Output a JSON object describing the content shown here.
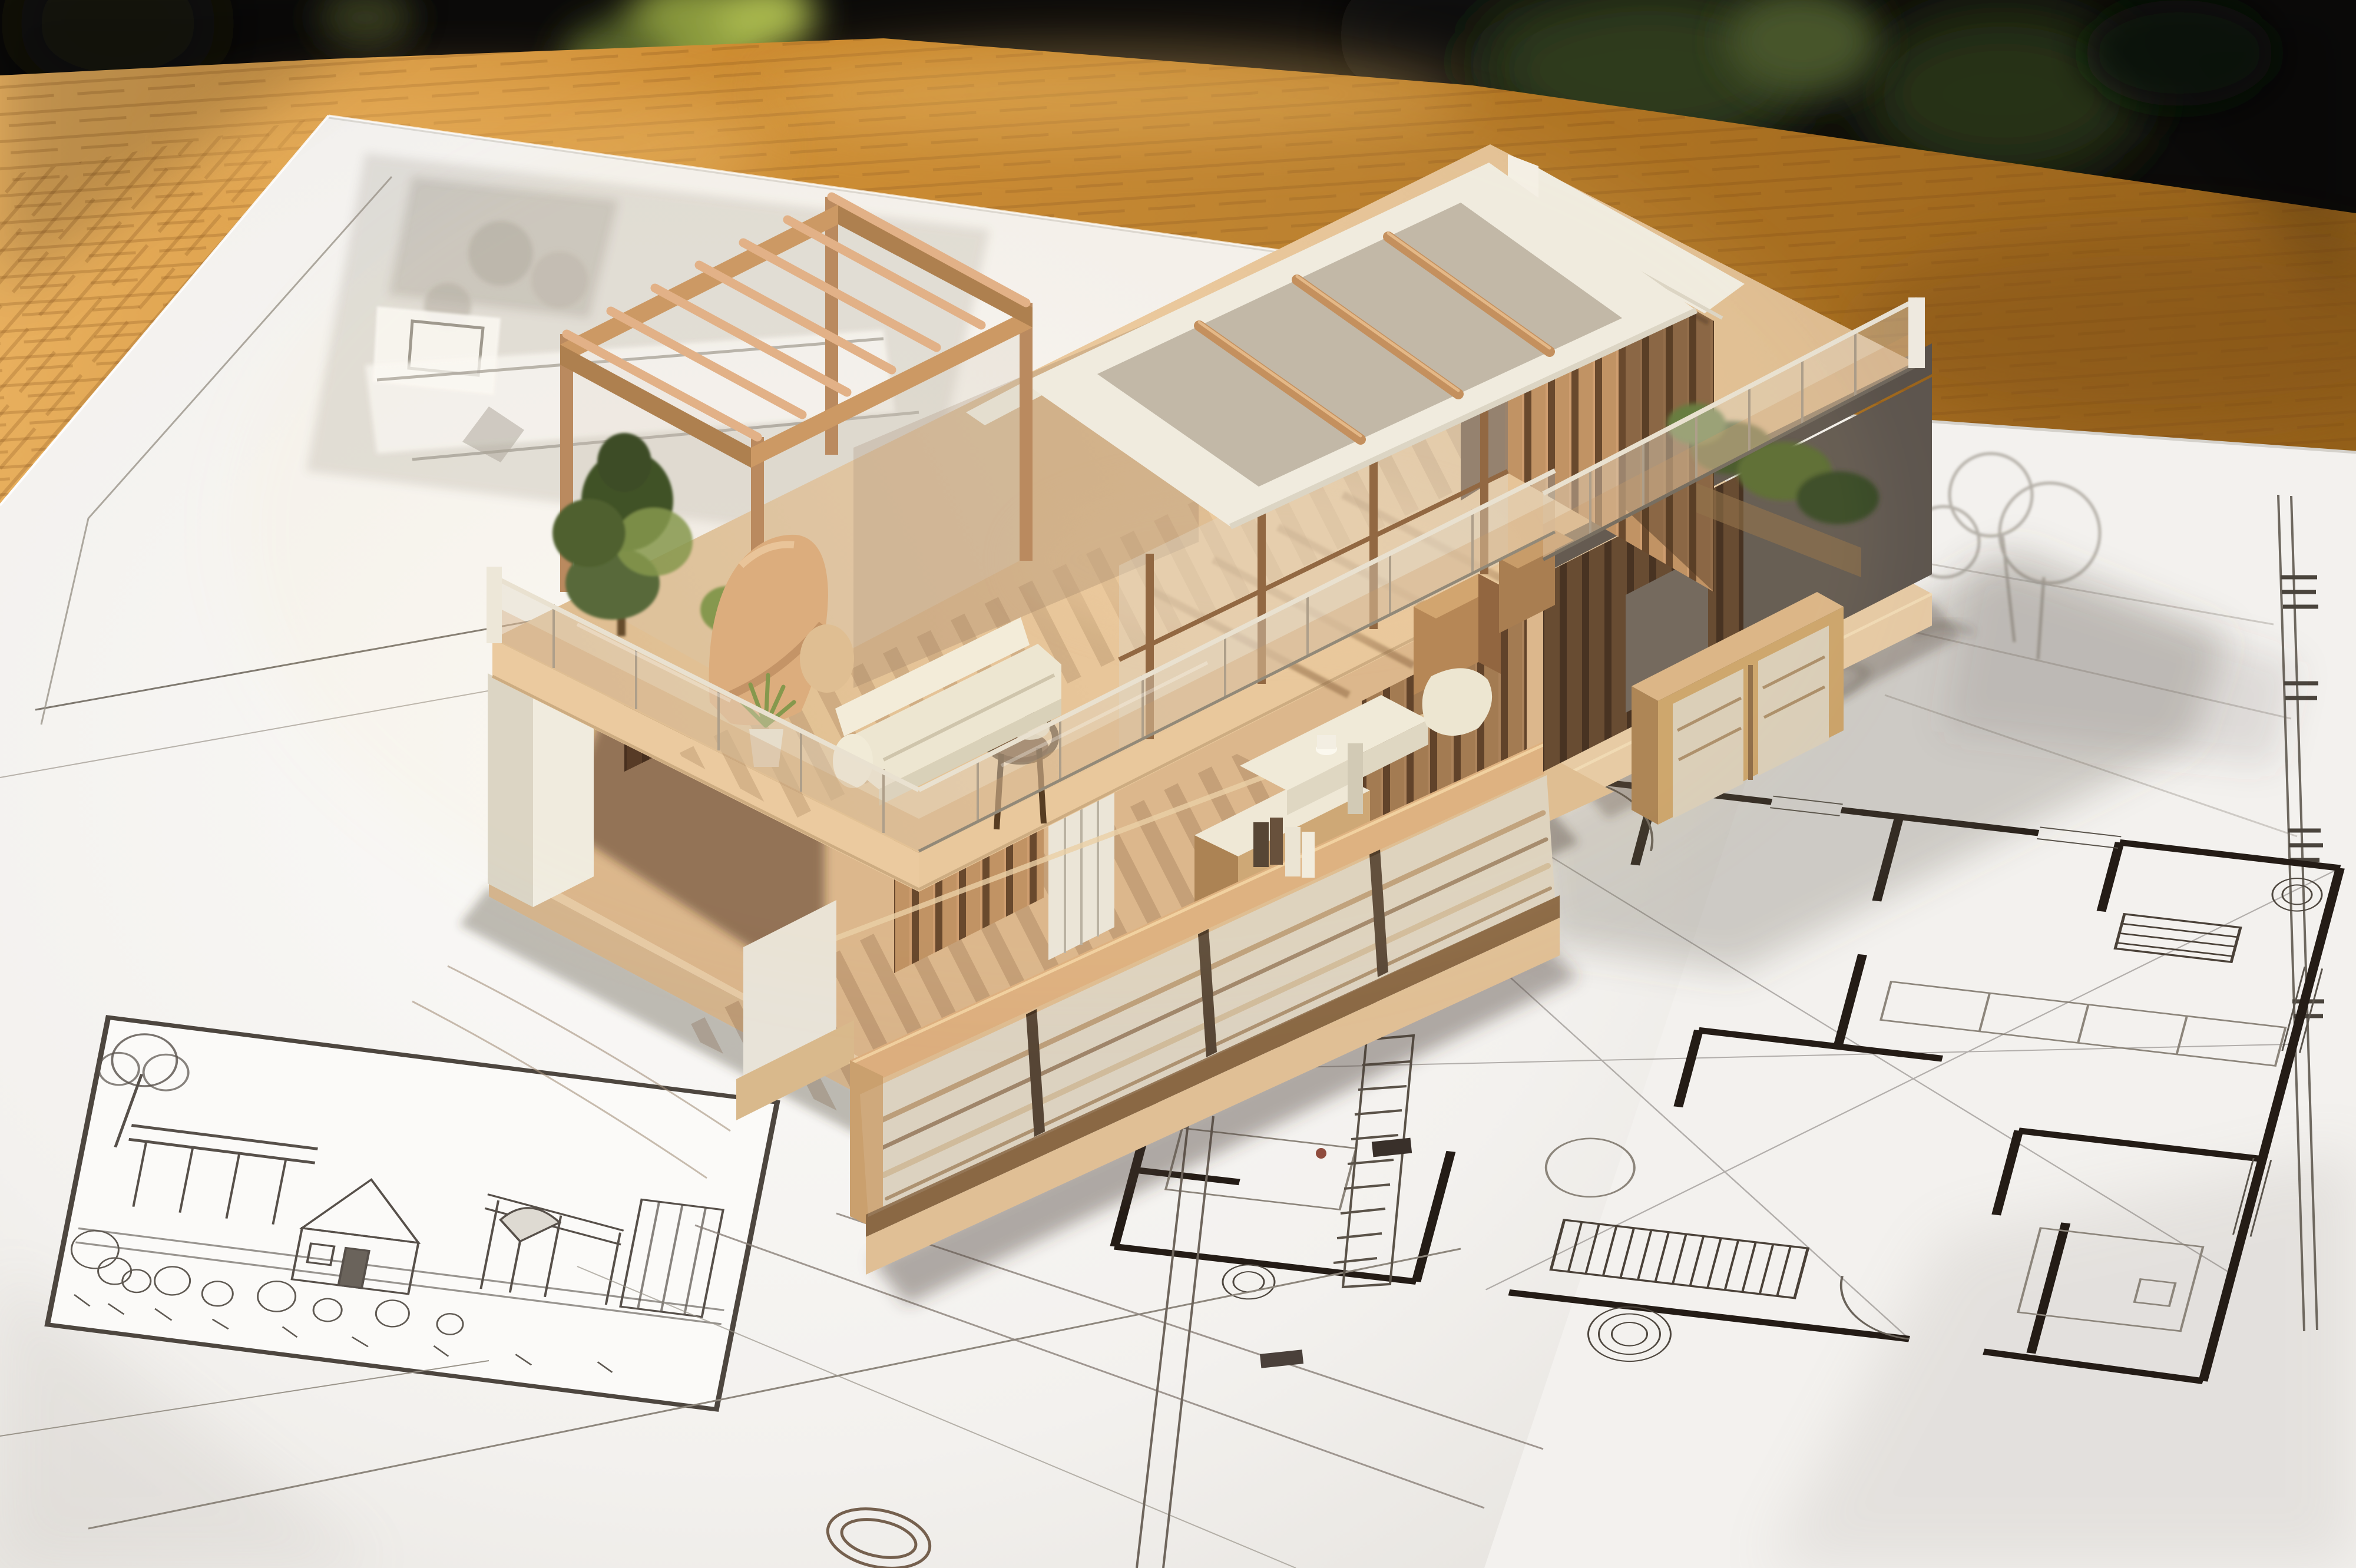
{
  "image": {
    "description": "Photograph of a wooden architectural scale model of a modern two-storey house standing on large white sheets of hand-drawn architectural blueprints, spread over a warm orange wooden desk; dark blurred background with hints of green plants."
  },
  "palette": {
    "bgDark": "#0b0a09",
    "bgDark2": "#161310",
    "plantGreen": "#55642a",
    "plantGreenLight": "#a9b84e",
    "plantGreenDark": "#273018",
    "woodTable": "#c9872c",
    "woodTableDark": "#94601a",
    "woodTableLight": "#eab261",
    "grainBrown": "rgba(122,72,20,0.28)",
    "paper": "#f3f1ee",
    "paperBright": "#fbfaf8",
    "paperShade": "#e3e0db",
    "paperEdge": "#d4d1cb",
    "inkDark": "#241c16",
    "ink": "#57504a",
    "inkLight": "#8d867c",
    "grayDraw": "#c9c5be",
    "grayDraw2": "#aaa59c",
    "modelWood": "#bc8d5f",
    "modelWoodDark": "#7e5636",
    "modelWoodDeep": "#5e3d24",
    "modelWoodLight": "#d7a377",
    "rafterLight": "#e0ad84",
    "deck": "#ddbb90",
    "deckWarm": "#e9c79c",
    "plinth": "#e5c9a4",
    "plinthShade": "#d3b38c",
    "railCap": "#dcae7e",
    "railFrame": "#43301f",
    "panelWeathered": "#d8cdb9",
    "white": "#efece2",
    "whiteShade": "#d9d4c6",
    "grayWall": "#5d554e",
    "grayFascia": "#59514a",
    "interiorDark": "#33241a",
    "glassTint": "rgba(222,212,198,0.42)",
    "glassWarm": "rgba(201,152,99,0.30)",
    "glassEdge": "#a89a88",
    "railTop": "#e7e1d3",
    "green": "#4c6030",
    "greenDark": "#33471f",
    "greenLight": "#7d9246",
    "cream": "#ece6d4",
    "creamShade": "#d6cfba",
    "tan": "#d9a97a",
    "tanDark": "#b9875c",
    "shadow": "rgba(70,58,45,0.40)",
    "castShadow": "rgba(95,88,80,0.26)",
    "stripeShadow": "rgba(110,70,40,0.38)"
  },
  "scene": {
    "background": "dark interior behind the desk with blurred green plants",
    "desk": "warm orange-brown wooden desk surface",
    "sheets": {
      "main": "large white blueprint sheet with pencil sketches under the model",
      "right": "blueprint sheet with a hand-drawn floor plan",
      "under": "edge of a second sheet tucked beneath the main sheet"
    },
    "drawings": {
      "site_plan": "faint grey site-plan rendering partly hidden behind the model",
      "perspective_sketch": "framed pencil perspective sketch of a small house with pergola, umbrella and bushes",
      "floor_plan": "hand-drawn floor plan with thick dark walls, door swing arcs, stair hatching and plant scribbles",
      "fragments": "loose construction lines, a hatched wall strip, dark wall chunks and a sketched bathtub below the model",
      "margin_marks": "double border line with illegible stamp marks along the right edge"
    },
    "model": {
      "description": "two-storey cutaway timber house model",
      "plinth": "light timber base plinth",
      "ground_floor": "open ground floor with vertical timber slat walls, white wardrobe panels and a stone-topped kitchen island",
      "porch_railing": "weathered timber balcony railing across the front",
      "upper_deck": "roof-terrace deck in light timber with long cast shadows",
      "glass_balustrade": "frameless glass balustrade wrapping the terrace",
      "pergola": "open timber pergola frame with round rafters",
      "glass_room": "glazed roof room with a white roof frame and timber rafters",
      "slat_wall": "tall vertical-slat timber wall capped with white coping",
      "right_wing": "grey concrete lower wing with recessed slatted opening",
      "furniture": "cream sofa, sculptural tan lounge, white desk with seat, dark timber chair, books and a potted plant",
      "greenery": "model trees and planter shrubs behind the glass",
      "cabinet": "slatted timber sideboard on the lower right deck"
    }
  }
}
